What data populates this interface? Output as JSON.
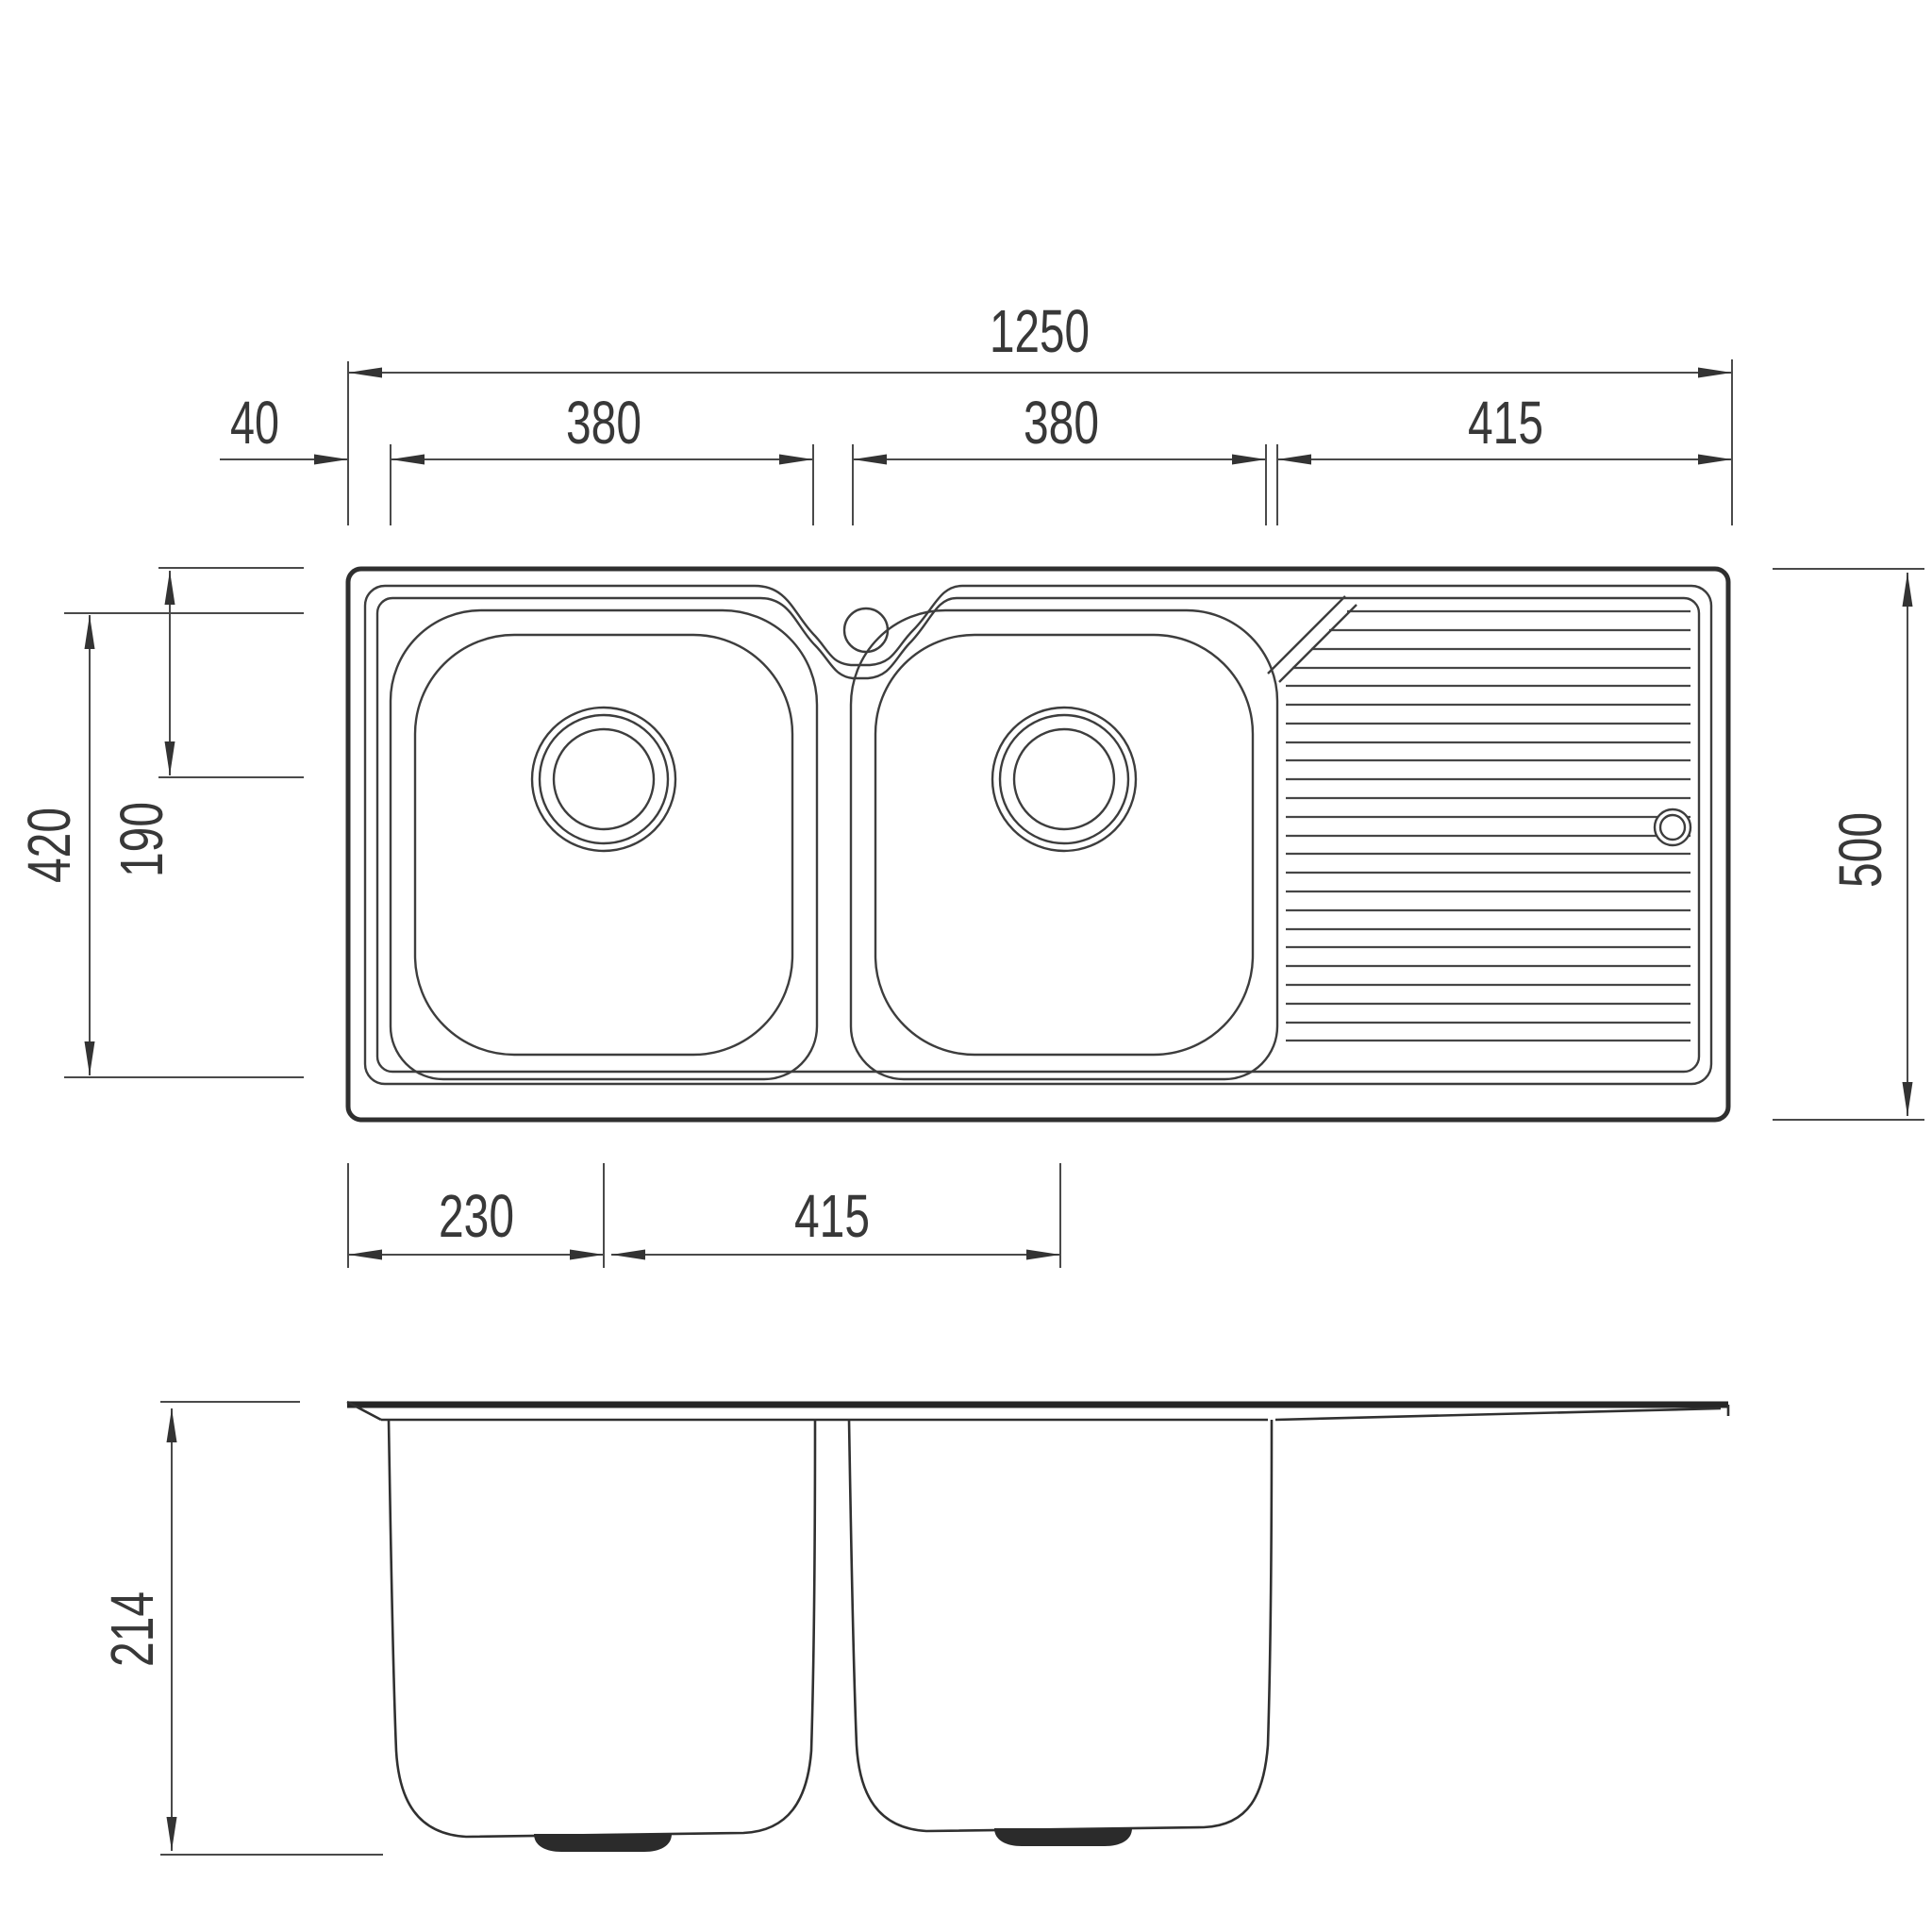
{
  "drawing": {
    "kind": "sink-technical-drawing",
    "colors": {
      "line": "#3d3d3d",
      "outline": "#2f2f2f",
      "dimension": "#4a4a4a",
      "text": "#383838",
      "background": "#ffffff"
    },
    "dims": {
      "total_width": "1250",
      "left_edge_offset": "40",
      "bowl1_width": "380",
      "bowl2_width": "380",
      "drainer_width": "415",
      "bowl_front_back": "420",
      "drain_center_offset": "190",
      "total_depth": "500",
      "drain1_from_edge": "230",
      "drain_spacing": "415",
      "bowl_depth": "214"
    }
  }
}
